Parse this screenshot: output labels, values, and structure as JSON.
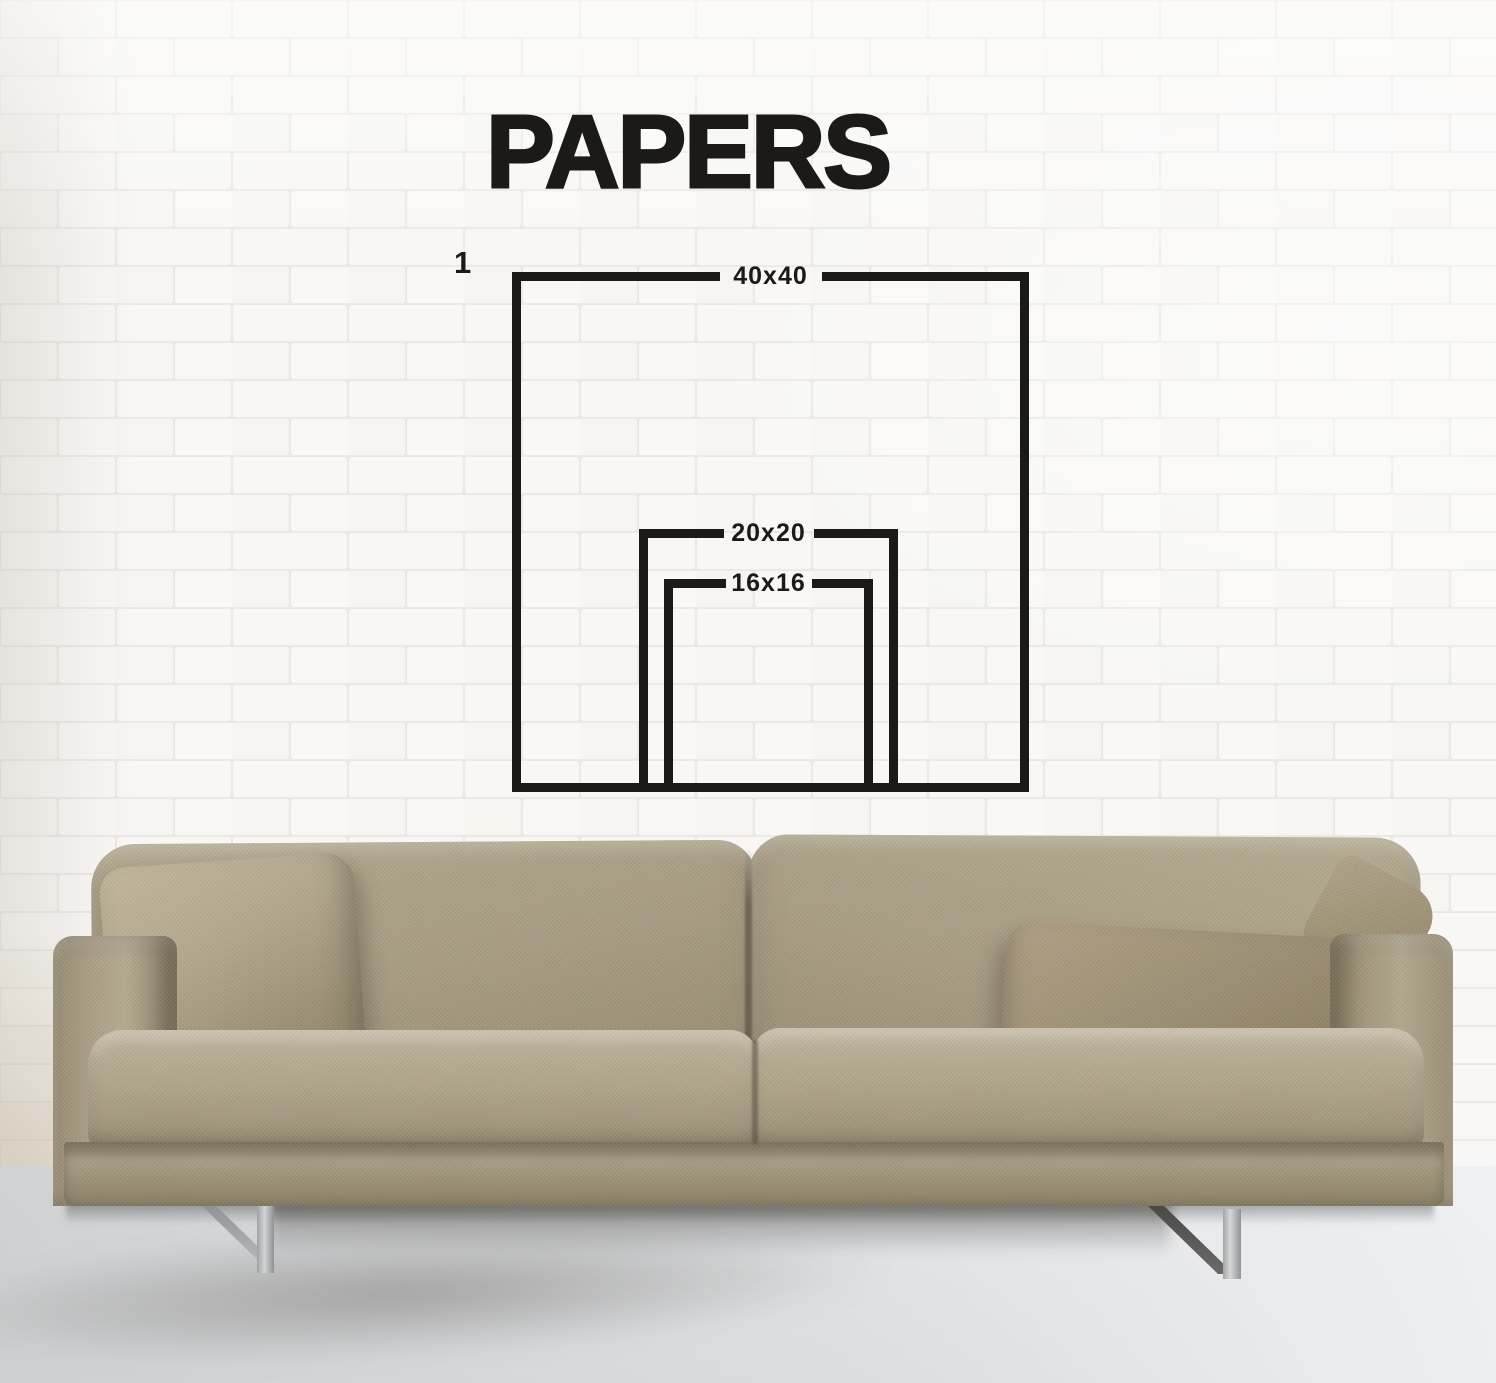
{
  "title": "PAPERS",
  "diagram": {
    "index_label": "1",
    "sizes": [
      {
        "label": "40x40"
      },
      {
        "label": "20x20"
      },
      {
        "label": "16x16"
      }
    ]
  },
  "colors": {
    "ink": "#1c1a19",
    "wall_brick": "#f8f7f5",
    "wall_mortar": "#e9e7e3",
    "floor": "#dcdee0",
    "sofa_fabric": "#a89d85",
    "sofa_fabric_light": "#beb49b",
    "sofa_fabric_dark": "#87795d",
    "pillow_right": "#9c8f74",
    "steel_leg": "#b9babc"
  },
  "scene": {
    "wall": "white-brick-wall",
    "floor": "grey-concrete-floor",
    "sofa": "beige-fabric-sofa",
    "pillow_left": "beige-throw-pillow",
    "pillow_right": "taupe-throw-pillow",
    "legs": "brushed-steel-sled-legs"
  }
}
